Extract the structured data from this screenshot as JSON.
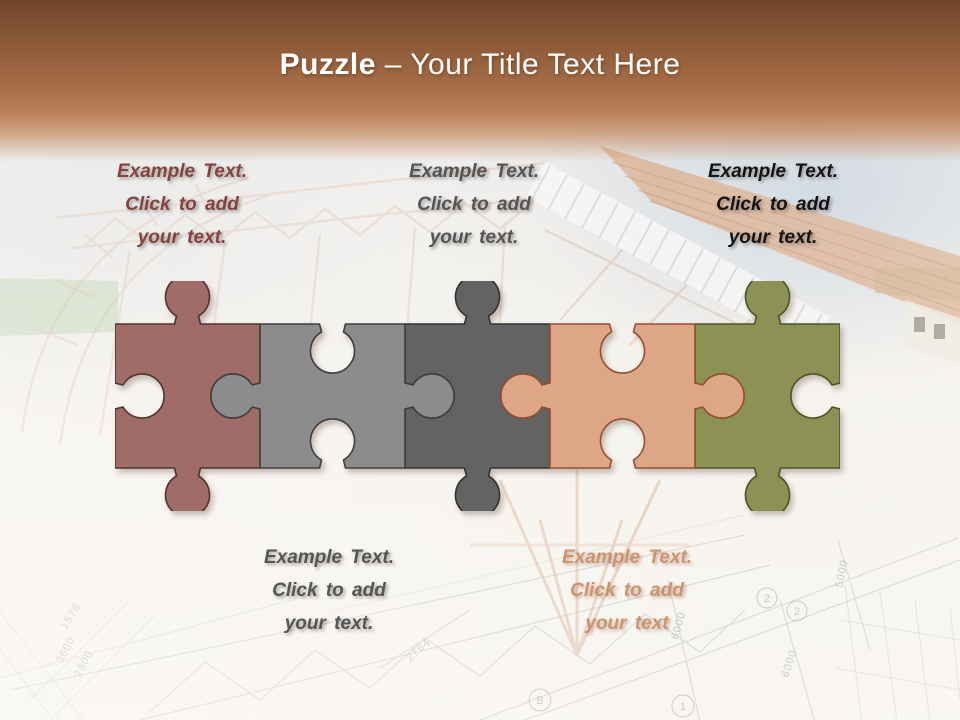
{
  "title": {
    "bold": "Puzzle",
    "rest": " – Your Title Text Here"
  },
  "text_blocks": [
    {
      "id": "top-left",
      "lines": [
        "Example Text.",
        "Click  to add",
        "your text."
      ],
      "color": "#84433f"
    },
    {
      "id": "top-center",
      "lines": [
        "Example Text.",
        "Click  to add",
        "your text."
      ],
      "color": "#555555"
    },
    {
      "id": "top-right",
      "lines": [
        "Example Text.",
        "Click  to add",
        "your text."
      ],
      "color": "#141414"
    },
    {
      "id": "bottom-left",
      "lines": [
        "Example Text.",
        "Click  to add",
        "your text."
      ],
      "color": "#555555"
    },
    {
      "id": "bottom-right",
      "lines": [
        "Example Text.",
        "Click  to add",
        "your text"
      ],
      "color": "#c8875f"
    }
  ],
  "puzzle": {
    "pieces": [
      {
        "label": "piece-1",
        "fill": "#a06c68",
        "stroke": "#553230"
      },
      {
        "label": "piece-2",
        "fill": "#8c8c8c",
        "stroke": "#3f3f3f"
      },
      {
        "label": "piece-3",
        "fill": "#636363",
        "stroke": "#333333"
      },
      {
        "label": "piece-4",
        "fill": "#dda687",
        "stroke": "#96512f"
      },
      {
        "label": "piece-5",
        "fill": "#8b9254",
        "stroke": "#4e5525"
      }
    ]
  },
  "background": {
    "dim_labels": [
      "1576",
      "3600",
      "2800",
      "2764",
      "6000",
      "6000",
      "5000"
    ],
    "grid_markers": [
      "B",
      "1",
      "2",
      "2"
    ]
  }
}
